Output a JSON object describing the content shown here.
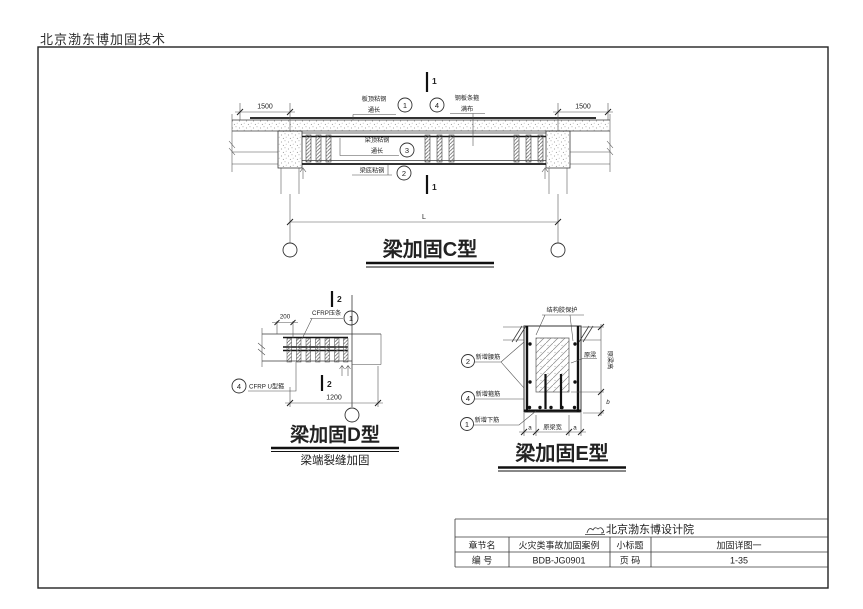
{
  "header": {
    "title": "北京渤东博加固技术"
  },
  "drawing_c": {
    "title": "梁加固C型",
    "section_label": "1",
    "dim_left": "1500",
    "dim_right": "1500",
    "dim_span": "L",
    "callout1": {
      "num": "1",
      "line1": "板顶粘钢",
      "line2": "通长"
    },
    "callout4": {
      "num": "4",
      "line1": "钢板条箍",
      "line2": "满布"
    },
    "callout3": {
      "num": "3",
      "line1": "梁顶粘钢",
      "line2": "通长"
    },
    "callout2": {
      "num": "2",
      "line1": "梁底粘钢"
    }
  },
  "drawing_d": {
    "title": "梁加固D型",
    "subtitle": "梁端裂缝加固",
    "section_label": "2",
    "dim_top": "200",
    "dim_bottom": "1200",
    "callout1": {
      "num": "1",
      "text": "CFRP压条"
    },
    "callout4": {
      "num": "4",
      "text": "CFRP U型箍"
    }
  },
  "drawing_e": {
    "title": "梁加固E型",
    "callout_top": "结构胶保护",
    "callout2": {
      "num": "2",
      "text": "新增腰筋"
    },
    "callout4": {
      "num": "4",
      "text": "新增箍筋"
    },
    "callout1": {
      "num": "1",
      "text": "新增下筋"
    },
    "label_original_beam": "原梁",
    "dim_height": "原梁高",
    "dim_added_height": "b",
    "dim_width": "原梁宽",
    "dim_added_width": "a"
  },
  "title_block": {
    "institute": "北京渤东博设计院",
    "row1": {
      "label1": "章节名",
      "value1": "火灾类事故加固案例",
      "label2": "小标题",
      "value2": "加固详图一"
    },
    "row2": {
      "label1": "编 号",
      "value1": "BDB-JG0901",
      "label2": "页 码",
      "value2": "1-35"
    }
  }
}
